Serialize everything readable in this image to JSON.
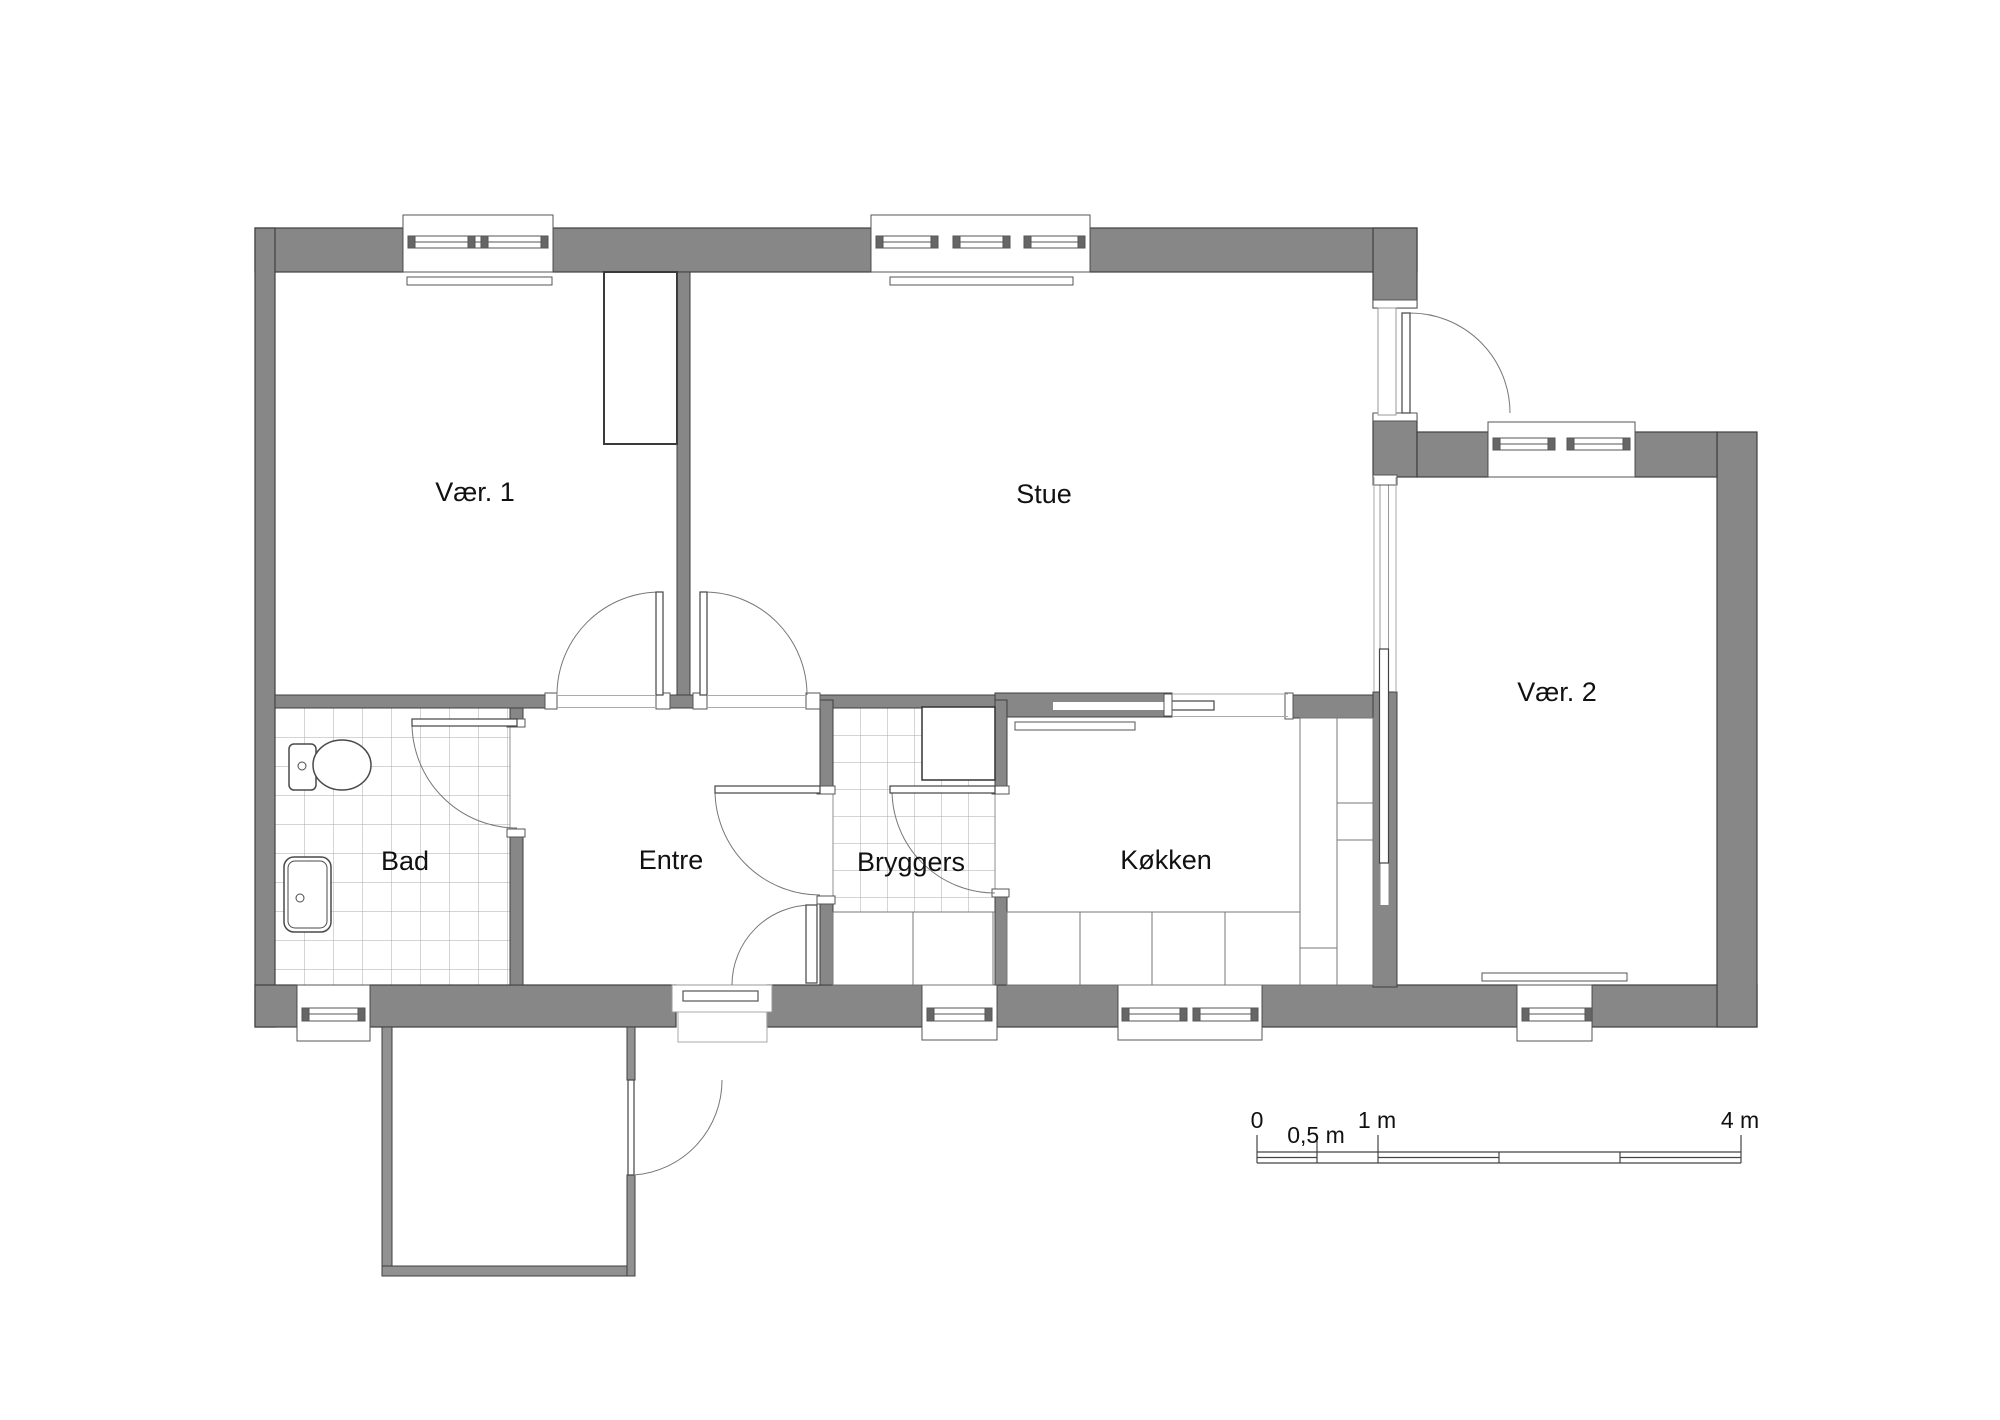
{
  "plan": {
    "rooms": [
      {
        "label": "Vær. 1"
      },
      {
        "label": "Stue"
      },
      {
        "label": "Vær. 2"
      },
      {
        "label": "Bad"
      },
      {
        "label": "Entre"
      },
      {
        "label": "Bryggers"
      },
      {
        "label": "Køkken"
      }
    ],
    "scale_bar": {
      "labels": [
        "0",
        "0,5 m",
        "1 m",
        "4 m"
      ]
    },
    "colors": {
      "wall": "#878787",
      "terrace_wall": "#919191",
      "outline": "#3f3f3f",
      "thin_line": "#555555",
      "tile_line": "#a8a8a8",
      "background": "#ffffff"
    }
  }
}
